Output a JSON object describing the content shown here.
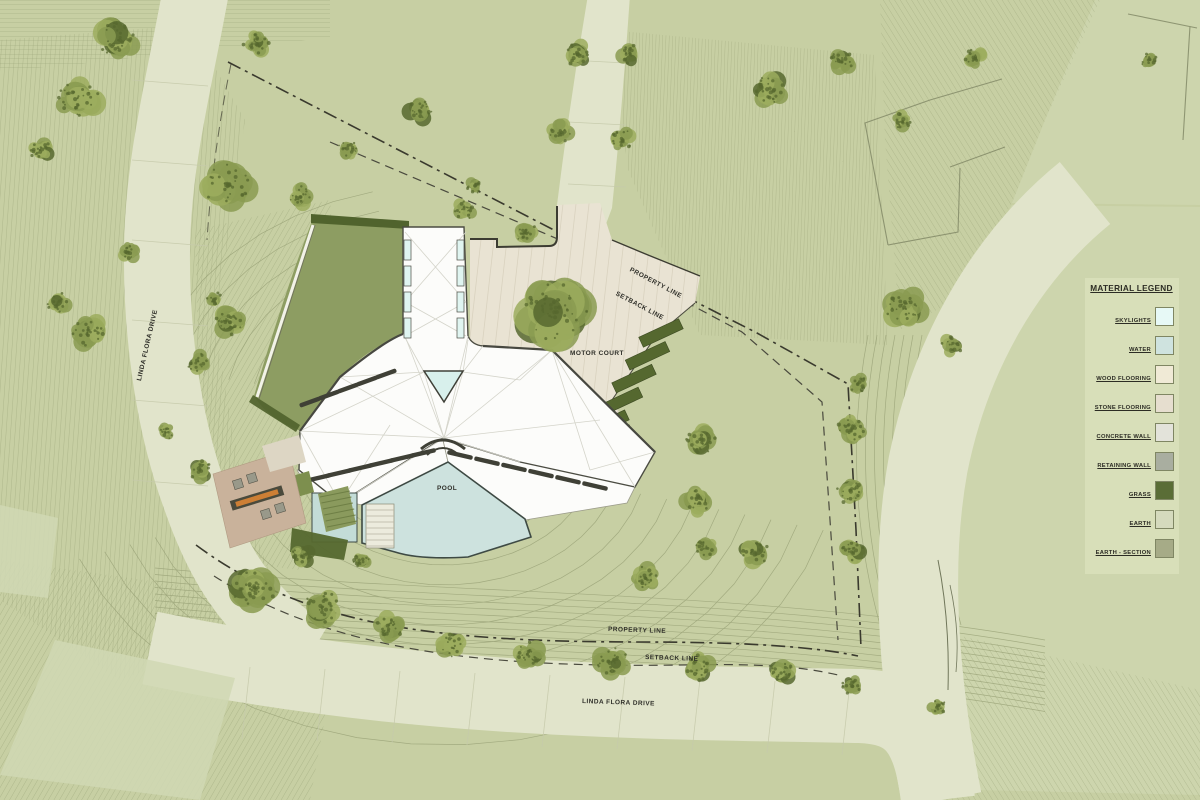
{
  "title": "Site Plan",
  "labels": {
    "motor_court": "MOTOR COURT",
    "pool": "POOL",
    "property_line_top": "PROPERTY LINE",
    "setback_line_top": "SETBACK LINE",
    "property_line_bottom": "PROPERTY LINE",
    "setback_line_bottom": "SETBACK LINE",
    "road_left": "LINDA FLORA DRIVE",
    "road_bottom": "LINDA FLORA DRIVE"
  },
  "legend": {
    "title": "MATERIAL LEGEND",
    "items": [
      {
        "label": "SKYLIGHTS",
        "color": "#e7f9f6"
      },
      {
        "label": "WATER",
        "color": "#cfe3df"
      },
      {
        "label": "WOOD FLOORING",
        "color": "#f0ead6"
      },
      {
        "label": "STONE FLOORING",
        "color": "#e6decf"
      },
      {
        "label": "CONCRETE WALL",
        "color": "#e3e3da"
      },
      {
        "label": "RETAINING WALL",
        "color": "#a9aea0"
      },
      {
        "label": "GRASS",
        "color": "#5a6d36"
      },
      {
        "label": "EARTH",
        "color": "#d5dabd"
      },
      {
        "label": "EARTH - SECTION",
        "color": "#a6ab87"
      }
    ]
  },
  "colors": {
    "background": "#c7cfa3",
    "contour": "#99a277",
    "road": "#e1e4cb",
    "road_patch": "#d0d8b4",
    "flat": "#cdd5ad",
    "stone": "#e9e3d3",
    "stone_joint": "#d9d2bf",
    "roof_white": "#fcfcfa",
    "roof_line": "#d4d4ca",
    "roof_edge": "#4b4c42",
    "skylight": "#e0f5f1",
    "water": "#cde2de",
    "spa": "#c3dcd7",
    "lawn": "#8d9d62",
    "hedge": "#50632d",
    "planter": "#55682f",
    "grass_strip": "#8a9a5d",
    "terrace": "#c9b29b",
    "terrace_stone": "#ddd6c4",
    "fireplace": "#cd7f35",
    "tree": "#8a9b51",
    "tree_light": "#9cad5e",
    "tree_dark": "#57682f",
    "property_line": "#3a3a2e",
    "setback_line": "#4a4a3e",
    "wall_line": "#3c3c32",
    "label": "#30302a"
  }
}
